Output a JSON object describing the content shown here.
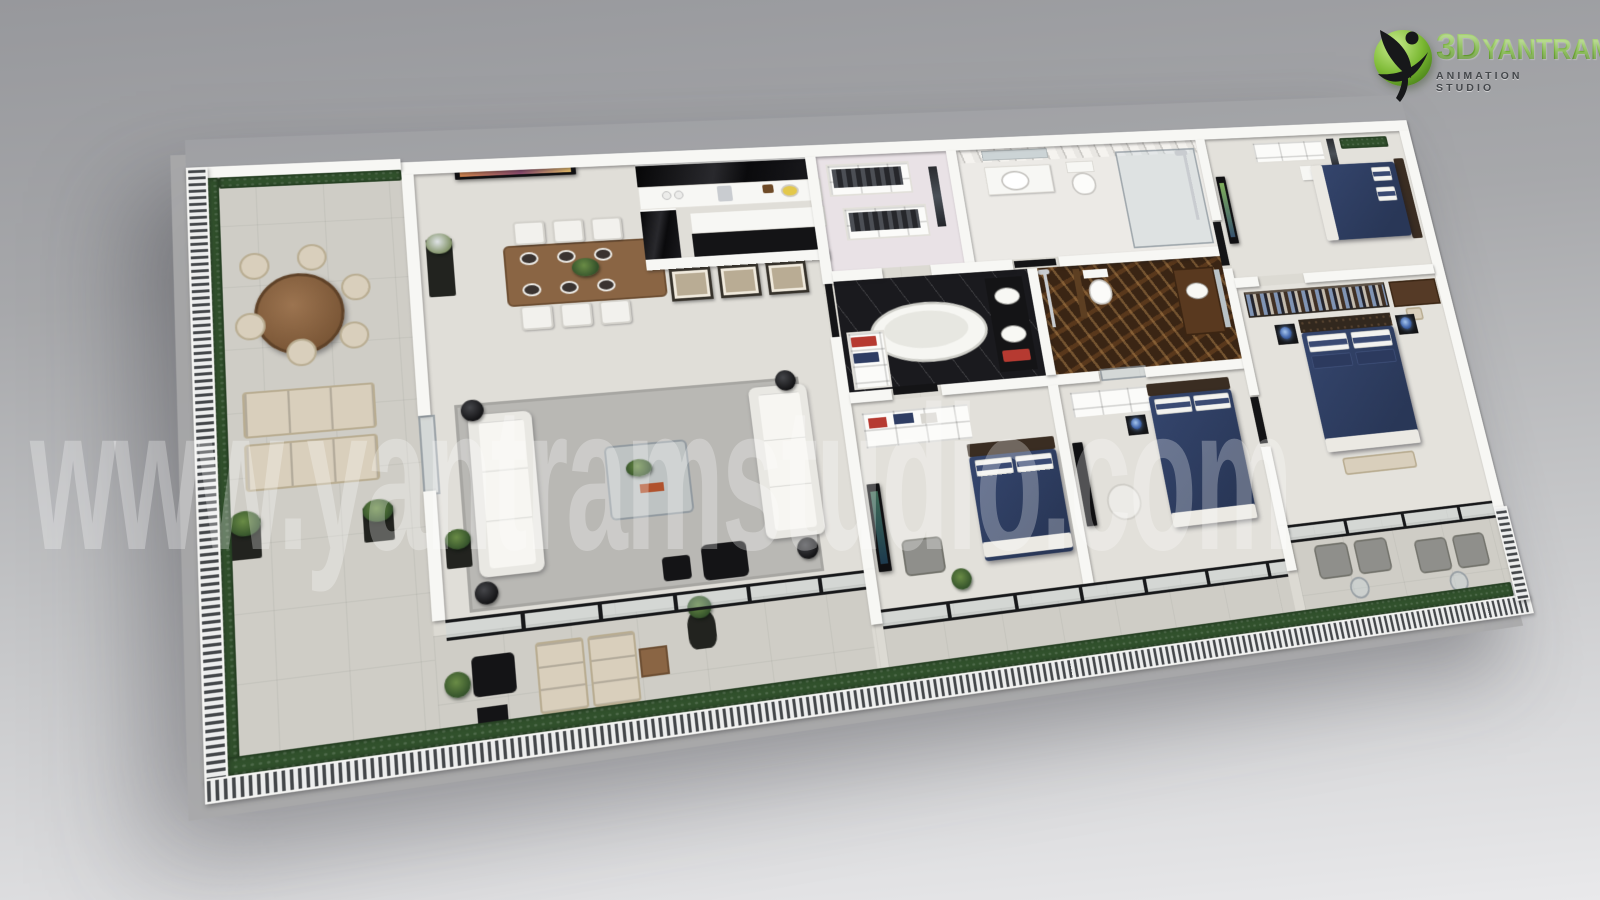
{
  "logo": {
    "brand_3d": "3D",
    "brand": "YANTRAM",
    "tagline": "ANIMATION STUDIO",
    "icon": "green-sphere-dancing-figure"
  },
  "watermark": {
    "text": "www.yantramstudio.com"
  },
  "colors": {
    "bg_top": "#97989c",
    "bg_bottom": "#e9e9eb",
    "wall": "#f7f7f4",
    "floor": "#dcdad3",
    "terrace": "#cfcdc6",
    "hedge": "#31512c",
    "rail_dark": "#44474a",
    "navy": "#35466e",
    "navy_deep": "#293757",
    "pillow_stripe": "#3a4a73",
    "black": "#141416",
    "wood": "#8a6544",
    "wood_dark": "#3a2d22",
    "cream": "#d9cfbc",
    "rug": "#b9b8b4",
    "brown_marble": "#3a2514",
    "chrome": "#c9ccd0",
    "accent_green": "#69a82b",
    "logo_text": "#44474b",
    "watermark": "rgba(255,255,255,0.28)"
  }
}
